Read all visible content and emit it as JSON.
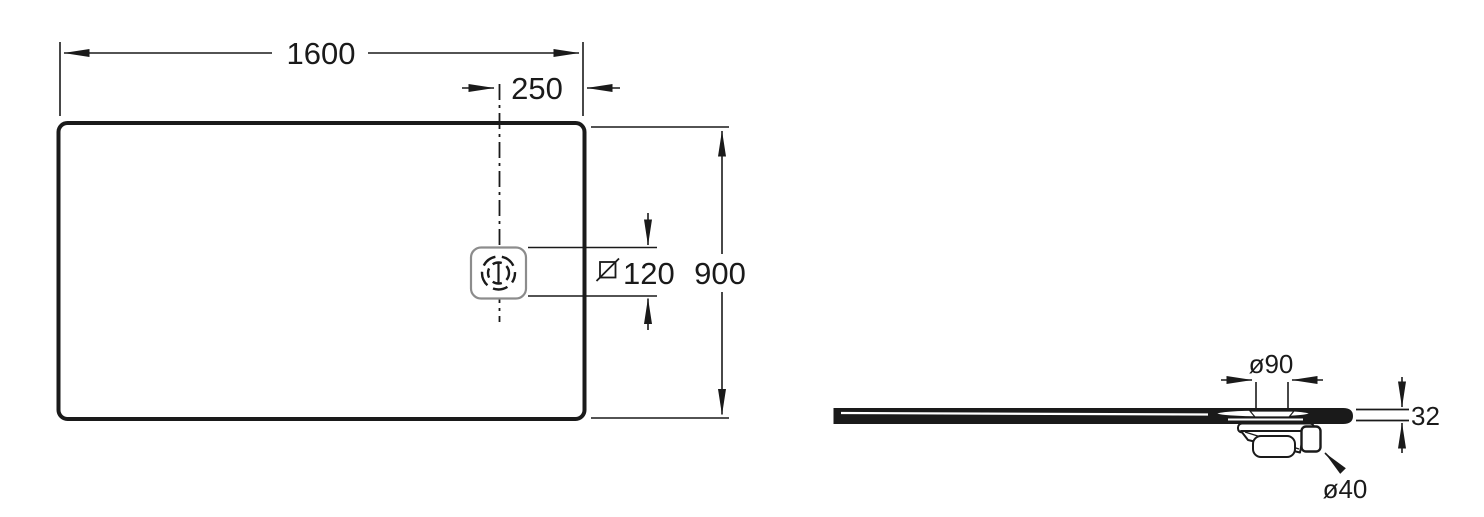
{
  "figure": {
    "type": "technical-dimension-drawing",
    "subject": "rectangular shower tray with offset drain, plan view and side section view",
    "background_color": "#ffffff",
    "line_color": "#1a1a1a",
    "drain_outline_color": "#8c8c8c",
    "text_color": "#1a1a1a"
  },
  "plan_view": {
    "name": "top (plan) view",
    "width_label": "1600",
    "drain_offset_label": "250",
    "height_label": "900",
    "drain_square_value": "120",
    "drain_square_symbol": "square-with-diagonal-slash",
    "drain_symbol": "round drain cap on centerline, dash-dot centerline through drain"
  },
  "side_view": {
    "name": "side section view",
    "drain_flange_diameter_label": "ø90",
    "tray_thickness_label": "32",
    "outlet_diameter_label": "ø40",
    "trap": "drain trap with side outlet below tray"
  }
}
